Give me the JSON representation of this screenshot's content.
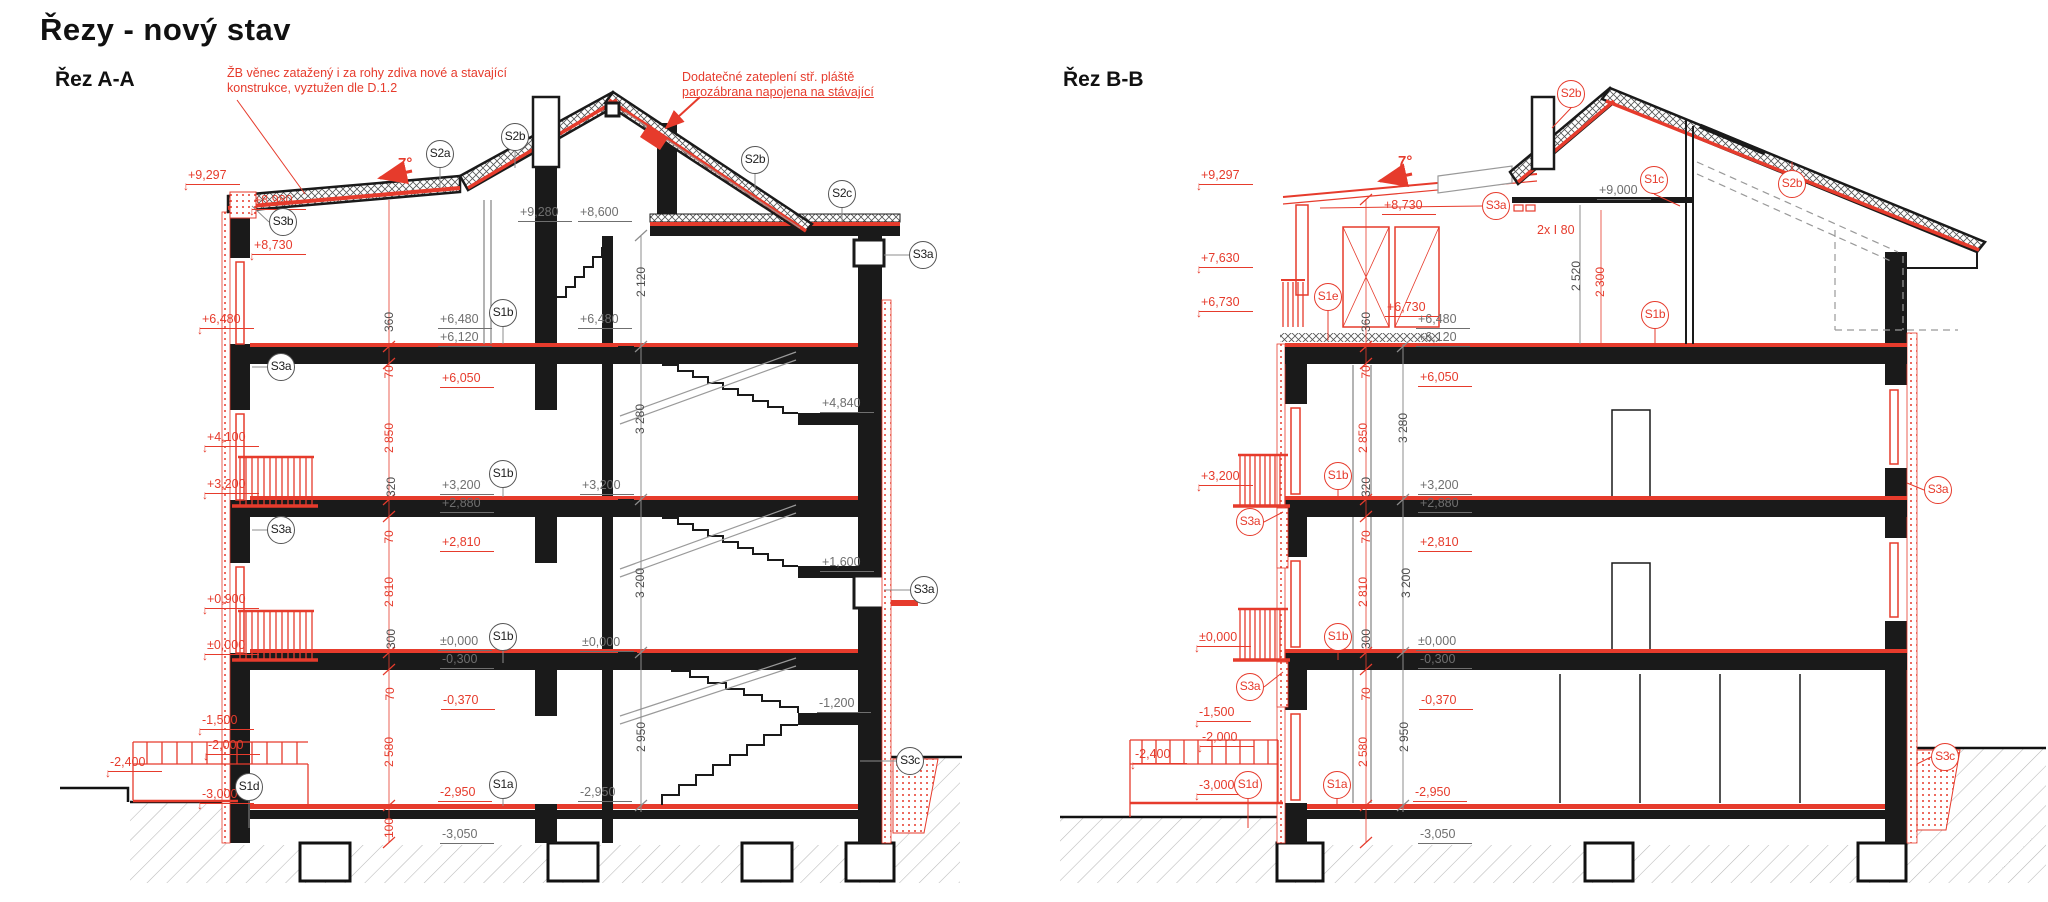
{
  "title": "Řezy - nový stav",
  "colors": {
    "red": "#e63b2c",
    "gray": "#6f6f6f",
    "dark": "#4d4d4d",
    "black": "#1a1a1a"
  },
  "section_labels": [
    {
      "text": "Řez A-A"
    },
    {
      "text": "Řez B-B"
    }
  ],
  "annotations": [
    {
      "lines": [
        "ŽB věnec zatažený i za rohy zdiva nové a stavající",
        "konstrukce, vyztužen dle D.1.2"
      ],
      "x": 227,
      "y": 66,
      "underline": false
    },
    {
      "lines": [
        "Dodatečné zateplení stř. pláště",
        "parozábrana napojena na stávající"
      ],
      "x": 682,
      "y": 70,
      "underline": true
    }
  ],
  "slope_labels": [
    {
      "t": "7°",
      "x": 398,
      "y": 155
    },
    {
      "t": "7°",
      "x": 1398,
      "y": 153
    }
  ],
  "levels": [
    {
      "t": "+9,297",
      "x": 186,
      "y": 169,
      "c": "red",
      "a": 1
    },
    {
      "t": "+8,980",
      "x": 252,
      "y": 194,
      "c": "red",
      "a": 1
    },
    {
      "t": "+8,730",
      "x": 252,
      "y": 239,
      "c": "red",
      "a": 1
    },
    {
      "t": "+6,480",
      "x": 200,
      "y": 313,
      "c": "red",
      "a": 1
    },
    {
      "t": "+4,100",
      "x": 205,
      "y": 431,
      "c": "red",
      "a": 1
    },
    {
      "t": "+3,200",
      "x": 205,
      "y": 478,
      "c": "red",
      "a": 1
    },
    {
      "t": "+0,900",
      "x": 205,
      "y": 593,
      "c": "red",
      "a": 1
    },
    {
      "t": "±0,000",
      "x": 205,
      "y": 639,
      "c": "red",
      "a": 1
    },
    {
      "t": "-1,500",
      "x": 200,
      "y": 714,
      "c": "red",
      "a": 1
    },
    {
      "t": "-2,000",
      "x": 206,
      "y": 739,
      "c": "red",
      "a": 1
    },
    {
      "t": "-2,400",
      "x": 108,
      "y": 756,
      "c": "red",
      "a": 1
    },
    {
      "t": "-3,000",
      "x": 200,
      "y": 788,
      "c": "red",
      "a": 1
    },
    {
      "t": "+9,280",
      "x": 518,
      "y": 206,
      "c": "gray"
    },
    {
      "t": "+8,600",
      "x": 578,
      "y": 206,
      "c": "gray"
    },
    {
      "t": "+6,480",
      "x": 438,
      "y": 313,
      "c": "gray"
    },
    {
      "t": "+6,120",
      "x": 438,
      "y": 331,
      "c": "gray"
    },
    {
      "t": "+6,480",
      "x": 578,
      "y": 313,
      "c": "gray"
    },
    {
      "t": "+6,050",
      "x": 440,
      "y": 372,
      "c": "red"
    },
    {
      "t": "+3,200",
      "x": 440,
      "y": 479,
      "c": "gray"
    },
    {
      "t": "+2,880",
      "x": 440,
      "y": 497,
      "c": "gray"
    },
    {
      "t": "+3,200",
      "x": 580,
      "y": 479,
      "c": "gray"
    },
    {
      "t": "+2,810",
      "x": 440,
      "y": 536,
      "c": "red"
    },
    {
      "t": "±0,000",
      "x": 438,
      "y": 635,
      "c": "gray"
    },
    {
      "t": "-0,300",
      "x": 440,
      "y": 653,
      "c": "gray"
    },
    {
      "t": "±0,000",
      "x": 580,
      "y": 636,
      "c": "gray"
    },
    {
      "t": "-0,370",
      "x": 441,
      "y": 694,
      "c": "red"
    },
    {
      "t": "-2,950",
      "x": 438,
      "y": 786,
      "c": "red"
    },
    {
      "t": "-2,950",
      "x": 578,
      "y": 786,
      "c": "gray"
    },
    {
      "t": "-3,050",
      "x": 440,
      "y": 828,
      "c": "gray"
    },
    {
      "t": "+4,840",
      "x": 820,
      "y": 397,
      "c": "gray"
    },
    {
      "t": "+1,600",
      "x": 820,
      "y": 556,
      "c": "gray"
    },
    {
      "t": "-1,200",
      "x": 817,
      "y": 697,
      "c": "gray"
    },
    {
      "t": "+9,297",
      "x": 1199,
      "y": 169,
      "c": "red",
      "a": 1
    },
    {
      "t": "+7,630",
      "x": 1199,
      "y": 252,
      "c": "red",
      "a": 1
    },
    {
      "t": "+6,730",
      "x": 1199,
      "y": 296,
      "c": "red",
      "a": 1
    },
    {
      "t": "+3,200",
      "x": 1199,
      "y": 470,
      "c": "red",
      "a": 1
    },
    {
      "t": "±0,000",
      "x": 1197,
      "y": 631,
      "c": "red",
      "a": 1
    },
    {
      "t": "-1,500",
      "x": 1197,
      "y": 706,
      "c": "red",
      "a": 1
    },
    {
      "t": "-2,000",
      "x": 1200,
      "y": 731,
      "c": "red",
      "a": 1
    },
    {
      "t": "-2,400",
      "x": 1133,
      "y": 748,
      "c": "red",
      "a": 1
    },
    {
      "t": "-3,000",
      "x": 1197,
      "y": 779,
      "c": "red",
      "a": 1
    },
    {
      "t": "+8,730",
      "x": 1382,
      "y": 199,
      "c": "red"
    },
    {
      "t": "+9,000",
      "x": 1597,
      "y": 184,
      "c": "gray"
    },
    {
      "t": "2x I 80",
      "x": 1535,
      "y": 224,
      "c": "red",
      "u": false
    },
    {
      "t": "+6,730",
      "x": 1385,
      "y": 301,
      "c": "red"
    },
    {
      "t": "+6,480",
      "x": 1416,
      "y": 313,
      "c": "gray"
    },
    {
      "t": "+6,120",
      "x": 1416,
      "y": 331,
      "c": "gray"
    },
    {
      "t": "+6,050",
      "x": 1418,
      "y": 371,
      "c": "red"
    },
    {
      "t": "+3,200",
      "x": 1418,
      "y": 479,
      "c": "gray"
    },
    {
      "t": "+2,880",
      "x": 1418,
      "y": 497,
      "c": "gray"
    },
    {
      "t": "+2,810",
      "x": 1418,
      "y": 536,
      "c": "red"
    },
    {
      "t": "±0,000",
      "x": 1416,
      "y": 635,
      "c": "gray"
    },
    {
      "t": "-0,300",
      "x": 1418,
      "y": 653,
      "c": "gray"
    },
    {
      "t": "-0,370",
      "x": 1419,
      "y": 694,
      "c": "red"
    },
    {
      "t": "-2,950",
      "x": 1413,
      "y": 786,
      "c": "red"
    },
    {
      "t": "-3,050",
      "x": 1418,
      "y": 828,
      "c": "gray"
    }
  ],
  "dims": [
    {
      "t": "360",
      "x": 389,
      "y": 322,
      "c": "dark"
    },
    {
      "t": "70",
      "x": 389,
      "y": 372,
      "c": "red"
    },
    {
      "t": "2 850",
      "x": 389,
      "y": 438,
      "c": "red"
    },
    {
      "t": "320",
      "x": 391,
      "y": 487,
      "c": "dark"
    },
    {
      "t": "70",
      "x": 389,
      "y": 537,
      "c": "red"
    },
    {
      "t": "2 810",
      "x": 389,
      "y": 592,
      "c": "red"
    },
    {
      "t": "300",
      "x": 391,
      "y": 639,
      "c": "dark"
    },
    {
      "t": "70",
      "x": 390,
      "y": 694,
      "c": "red"
    },
    {
      "t": "2 580",
      "x": 389,
      "y": 752,
      "c": "red"
    },
    {
      "t": "100",
      "x": 389,
      "y": 828,
      "c": "red"
    },
    {
      "t": "2 120",
      "x": 641,
      "y": 282,
      "c": "dark"
    },
    {
      "t": "3 280",
      "x": 640,
      "y": 419,
      "c": "dark"
    },
    {
      "t": "3 200",
      "x": 640,
      "y": 583,
      "c": "dark"
    },
    {
      "t": "2 950",
      "x": 641,
      "y": 737,
      "c": "dark"
    },
    {
      "t": "2 520",
      "x": 1576,
      "y": 276,
      "c": "dark"
    },
    {
      "t": "2 300",
      "x": 1600,
      "y": 282,
      "c": "red"
    },
    {
      "t": "360",
      "x": 1366,
      "y": 322,
      "c": "dark"
    },
    {
      "t": "70",
      "x": 1366,
      "y": 372,
      "c": "red"
    },
    {
      "t": "2 850",
      "x": 1363,
      "y": 438,
      "c": "red"
    },
    {
      "t": "320",
      "x": 1366,
      "y": 487,
      "c": "dark"
    },
    {
      "t": "70",
      "x": 1366,
      "y": 537,
      "c": "red"
    },
    {
      "t": "2 810",
      "x": 1363,
      "y": 592,
      "c": "red"
    },
    {
      "t": "300",
      "x": 1366,
      "y": 639,
      "c": "dark"
    },
    {
      "t": "70",
      "x": 1366,
      "y": 694,
      "c": "red"
    },
    {
      "t": "2 580",
      "x": 1363,
      "y": 752,
      "c": "red"
    },
    {
      "t": "3 280",
      "x": 1403,
      "y": 428,
      "c": "dark"
    },
    {
      "t": "3 200",
      "x": 1406,
      "y": 583,
      "c": "dark"
    },
    {
      "t": "2 950",
      "x": 1404,
      "y": 737,
      "c": "dark"
    }
  ],
  "circles": [
    {
      "t": "S2a",
      "x": 440,
      "y": 154,
      "c": "dark"
    },
    {
      "t": "S2b",
      "x": 515,
      "y": 137,
      "c": "dark"
    },
    {
      "t": "S2b",
      "x": 755,
      "y": 160,
      "c": "dark"
    },
    {
      "t": "S2c",
      "x": 842,
      "y": 194,
      "c": "dark"
    },
    {
      "t": "S3b",
      "x": 283,
      "y": 222,
      "c": "dark"
    },
    {
      "t": "S3a",
      "x": 281,
      "y": 367,
      "c": "dark"
    },
    {
      "t": "S3a",
      "x": 281,
      "y": 530,
      "c": "dark"
    },
    {
      "t": "S3a",
      "x": 923,
      "y": 255,
      "c": "dark"
    },
    {
      "t": "S3a",
      "x": 924,
      "y": 590,
      "c": "dark"
    },
    {
      "t": "S3c",
      "x": 910,
      "y": 761,
      "c": "dark"
    },
    {
      "t": "S1b",
      "x": 503,
      "y": 313,
      "c": "dark"
    },
    {
      "t": "S1b",
      "x": 503,
      "y": 474,
      "c": "dark"
    },
    {
      "t": "S1b",
      "x": 503,
      "y": 637,
      "c": "dark"
    },
    {
      "t": "S1a",
      "x": 503,
      "y": 785,
      "c": "dark"
    },
    {
      "t": "S1d",
      "x": 249,
      "y": 787,
      "c": "dark"
    },
    {
      "t": "S2b",
      "x": 1571,
      "y": 94,
      "c": "red"
    },
    {
      "t": "S1c",
      "x": 1654,
      "y": 180,
      "c": "red"
    },
    {
      "t": "S2b",
      "x": 1792,
      "y": 184,
      "c": "red"
    },
    {
      "t": "S3a",
      "x": 1496,
      "y": 206,
      "c": "red"
    },
    {
      "t": "S1e",
      "x": 1328,
      "y": 297,
      "c": "red"
    },
    {
      "t": "S1b",
      "x": 1655,
      "y": 315,
      "c": "red"
    },
    {
      "t": "S1b",
      "x": 1338,
      "y": 476,
      "c": "red"
    },
    {
      "t": "S1b",
      "x": 1338,
      "y": 637,
      "c": "red"
    },
    {
      "t": "S3a",
      "x": 1250,
      "y": 522,
      "c": "red"
    },
    {
      "t": "S3a",
      "x": 1250,
      "y": 687,
      "c": "red"
    },
    {
      "t": "S1d",
      "x": 1248,
      "y": 785,
      "c": "red"
    },
    {
      "t": "S1a",
      "x": 1337,
      "y": 785,
      "c": "red"
    },
    {
      "t": "S3a",
      "x": 1938,
      "y": 490,
      "c": "red"
    },
    {
      "t": "S3c",
      "x": 1945,
      "y": 757,
      "c": "red"
    }
  ]
}
